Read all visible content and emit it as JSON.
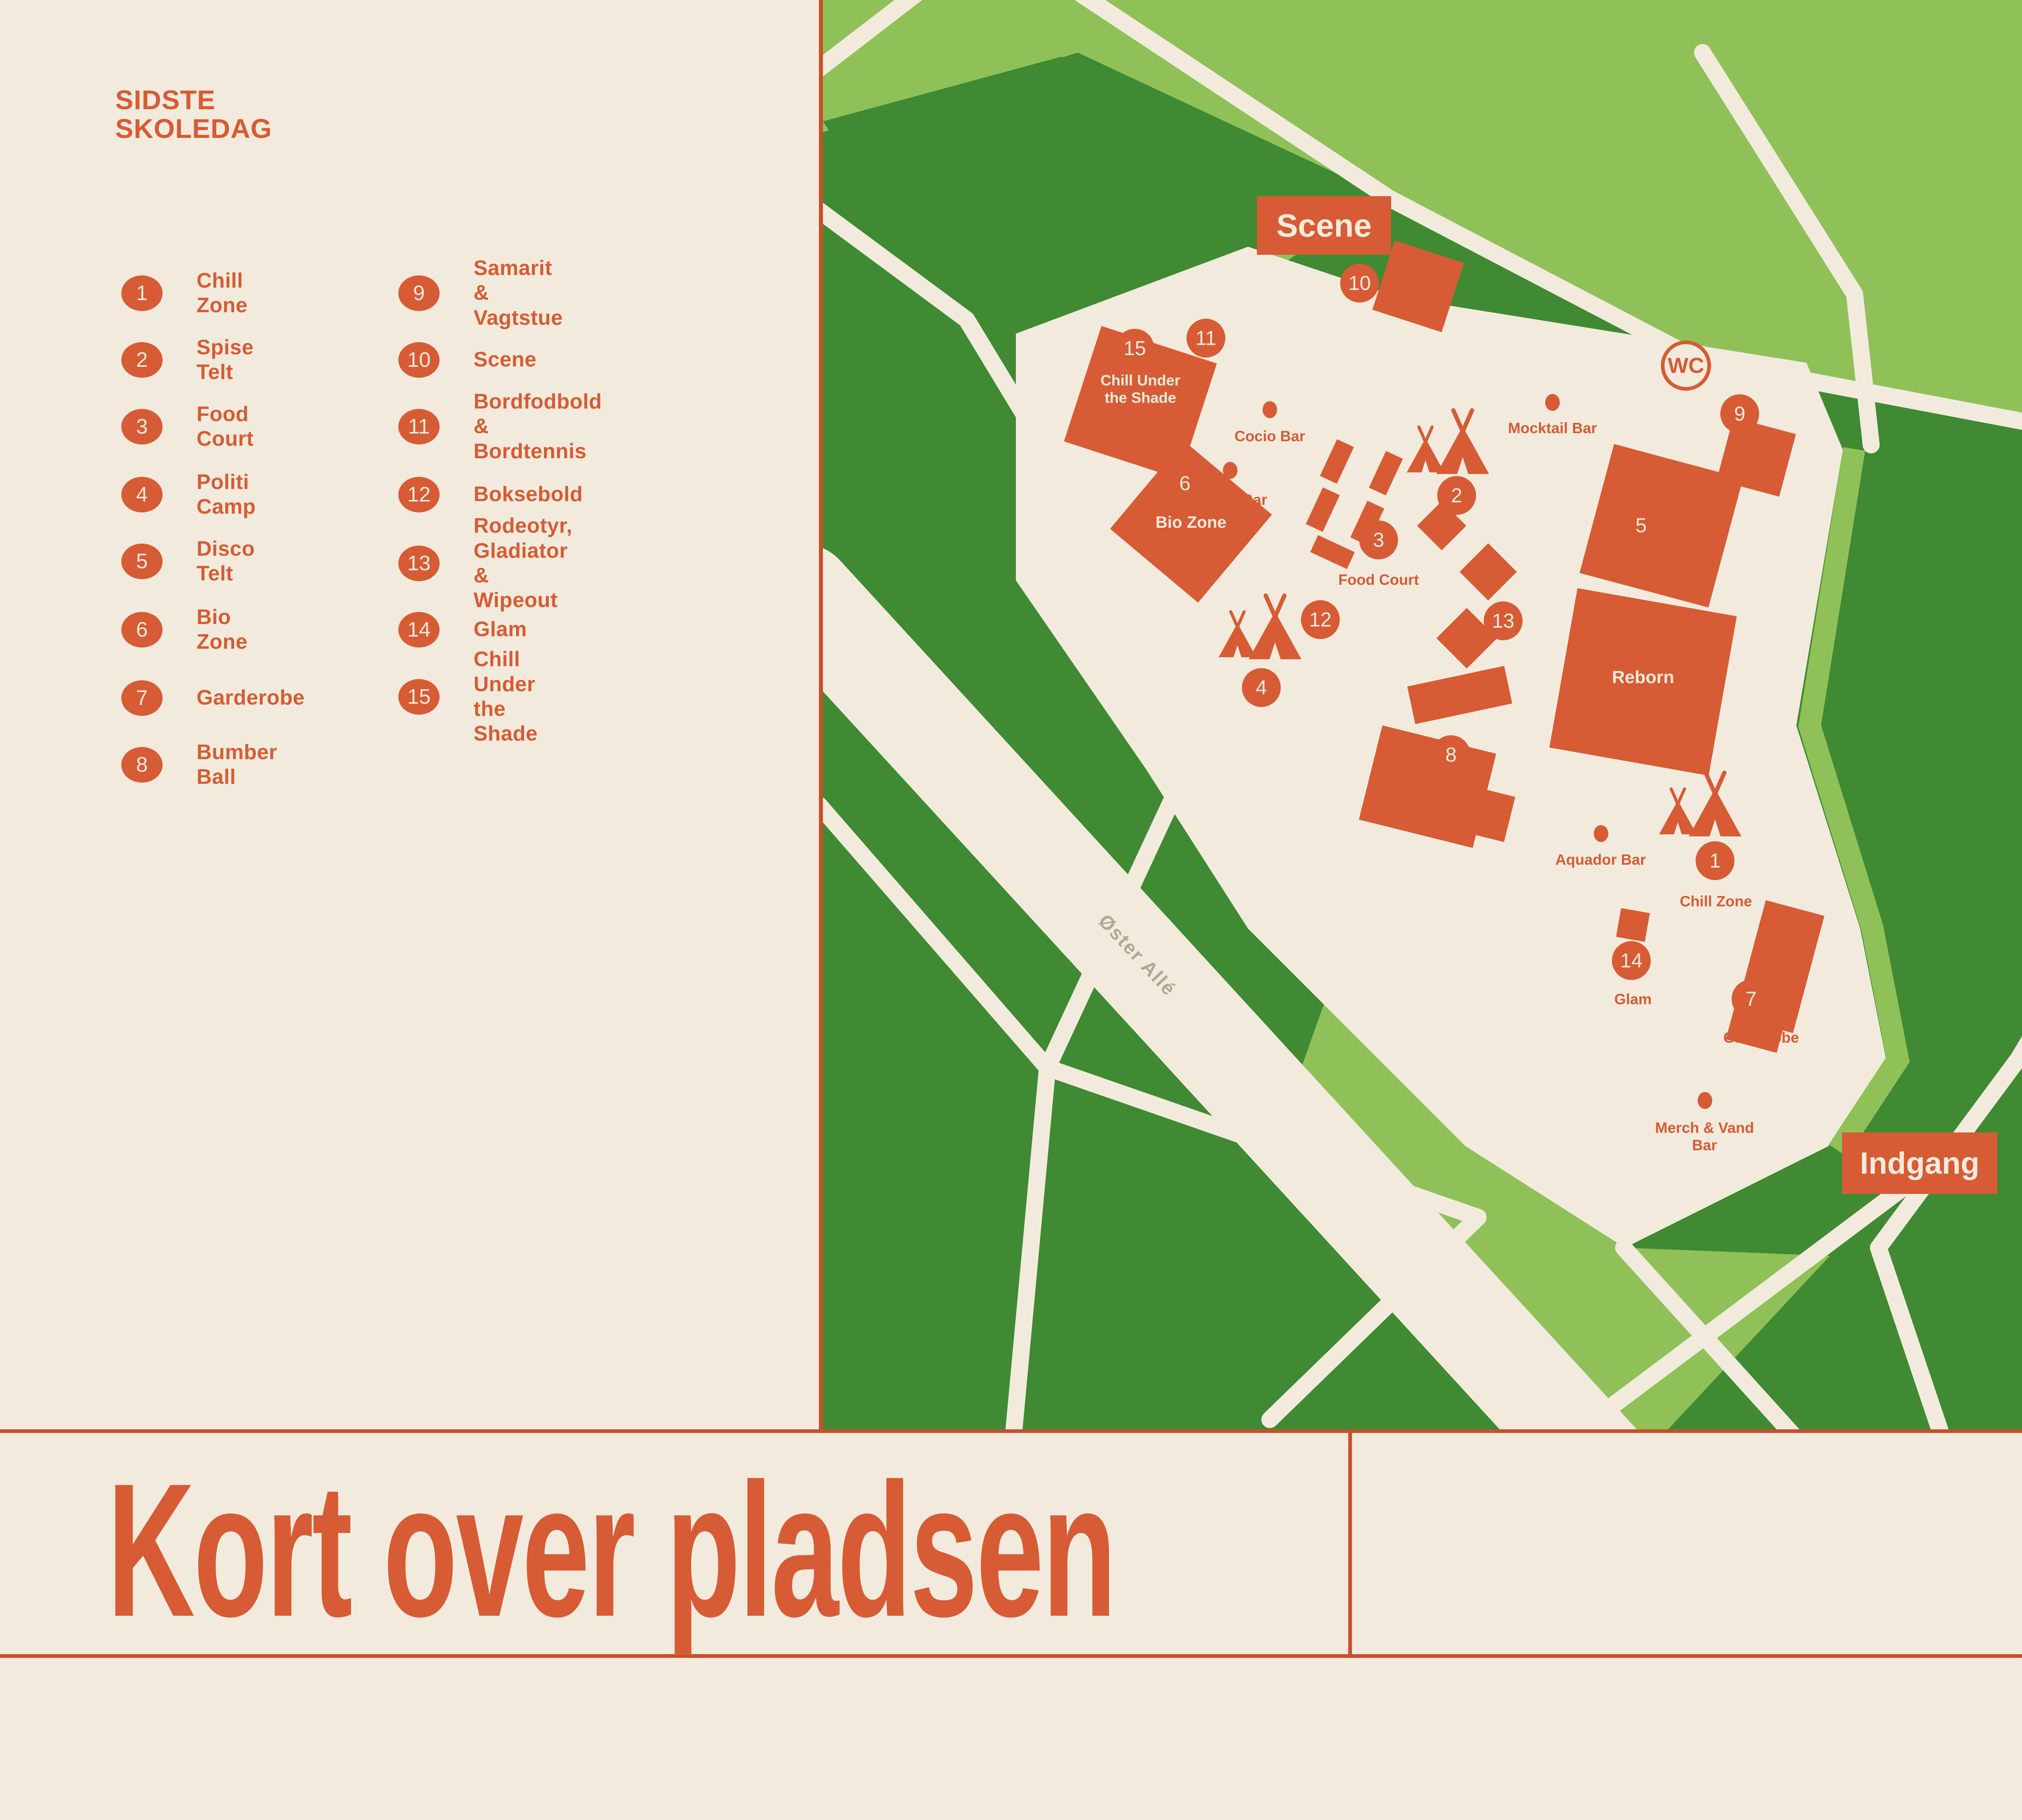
{
  "logo": {
    "line1": "SIDSTE",
    "line2": "SKOLEDAG"
  },
  "title": "Kort over pladsen",
  "colors": {
    "orange": "#D75B34",
    "cream": "#F2EBDD",
    "light_green": "#90C159",
    "dark_green": "#3F8A33",
    "taupe": "#C6BEAB",
    "road_label_gray": "#AFA893",
    "border_line": "#C94F2A"
  },
  "legend": {
    "items": [
      {
        "num": "1",
        "label": "Chill Zone"
      },
      {
        "num": "2",
        "label": "Spise Telt"
      },
      {
        "num": "3",
        "label": "Food Court"
      },
      {
        "num": "4",
        "label": "Politi Camp"
      },
      {
        "num": "5",
        "label": "Disco Telt"
      },
      {
        "num": "6",
        "label": "Bio Zone"
      },
      {
        "num": "7",
        "label": "Garderobe"
      },
      {
        "num": "8",
        "label": "Bumber Ball"
      },
      {
        "num": "9",
        "label": "Samarit & Vagtstue"
      },
      {
        "num": "10",
        "label": "Scene"
      },
      {
        "num": "11",
        "label": "Bordfodbold &\nBordtennis"
      },
      {
        "num": "12",
        "label": "Boksebold"
      },
      {
        "num": "13",
        "label": "Rodeotyr, Gladiator\n& Wipeout"
      },
      {
        "num": "14",
        "label": "Glam"
      },
      {
        "num": "15",
        "label": "Chill Under\nthe Shade"
      }
    ]
  },
  "map": {
    "scene": "Scene",
    "indgang": "Indgang",
    "parken": "Parken",
    "wc": "WC",
    "road": "Øster Allé",
    "markers": {
      "m1": "1",
      "m2": "2",
      "m3": "3",
      "m4": "4",
      "m5": "5",
      "m6": "6",
      "m7": "7",
      "m8": "8",
      "m9": "9",
      "m10": "10",
      "m11": "11",
      "m12": "12",
      "m13": "13",
      "m14": "14",
      "m15": "15"
    },
    "labels": {
      "chill_under": "Chill Under\nthe Shade",
      "bio": "Bio Zone",
      "reborn": "Reborn",
      "disco": "Disco Telt",
      "food": "Food Court",
      "cocio": "Cocio Bar",
      "snack": "Snack Bar",
      "mocktail": "Mocktail Bar",
      "aquador": "Aquador Bar",
      "merch": "Merch & Vand\nBar",
      "chill_zone": "Chill Zone",
      "garderobe": "Garderobe",
      "glam": "Glam"
    }
  }
}
